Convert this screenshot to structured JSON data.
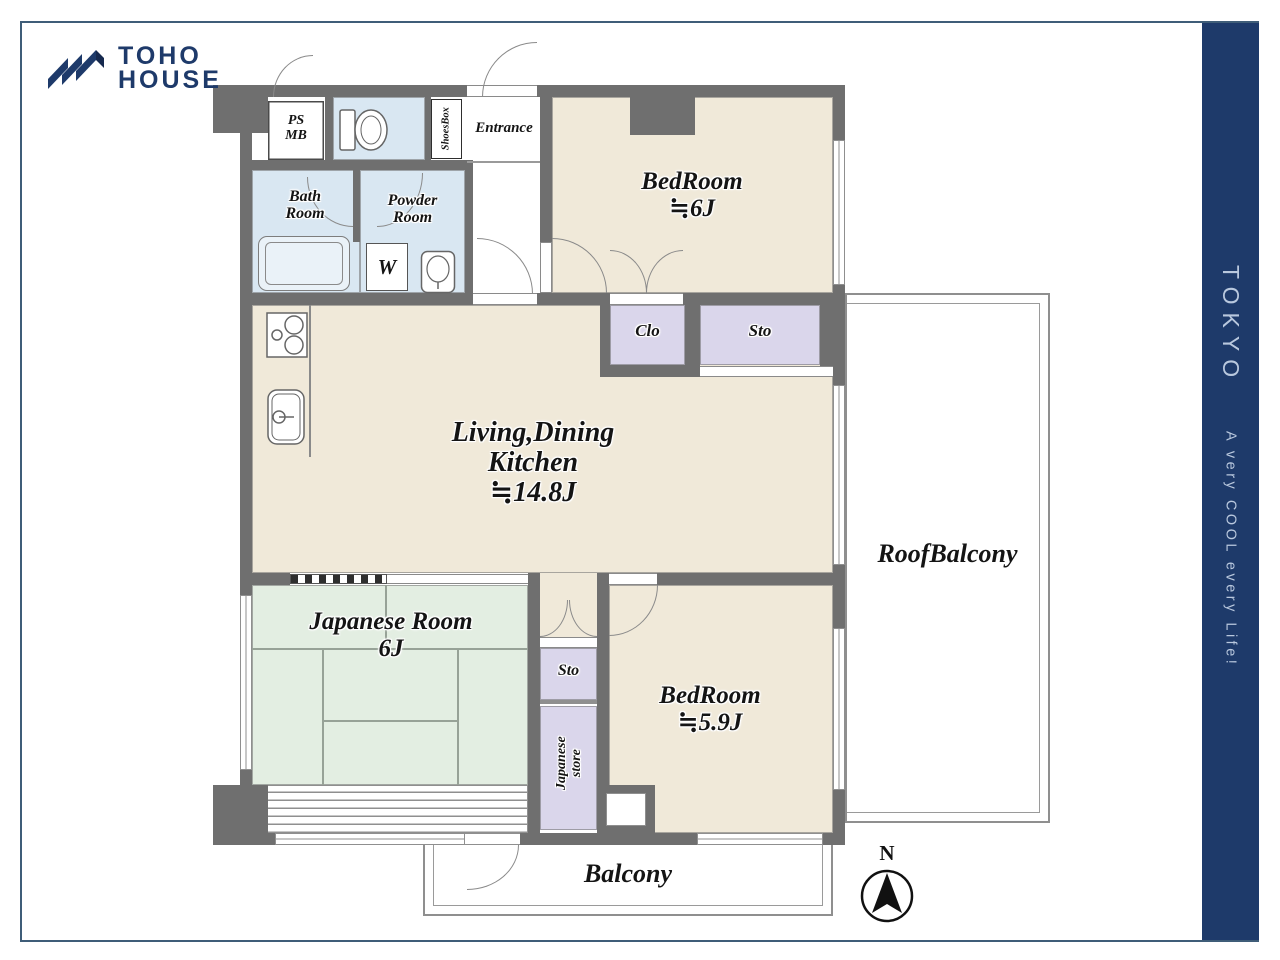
{
  "brand": {
    "name_line1": "TOHO",
    "name_line2": "HOUSE"
  },
  "sidebar": {
    "region": "TOKYO",
    "tagline": "A very COOL every Life!"
  },
  "compass": {
    "north": "N"
  },
  "rooms": {
    "bedroom_north": {
      "name": "BedRoom",
      "size": "≒6J"
    },
    "ldk": {
      "line1": "Living,Dining",
      "line2": "Kitchen",
      "size": "≒14.8J"
    },
    "japanese_room": {
      "name": "Japanese Room",
      "size": "6J"
    },
    "bedroom_south": {
      "name": "BedRoom",
      "size": "≒5.9J"
    },
    "roof_balcony": "RoofBalcony",
    "balcony": "Balcony",
    "closet": "Clo",
    "storage_north": "Sto",
    "storage_south": "Sto",
    "japanese_store_line1": "Japanese",
    "japanese_store_line2": "store",
    "bath_line1": "Bath",
    "bath_line2": "Room",
    "powder_line1": "Powder",
    "powder_line2": "Room",
    "entrance": "Entrance",
    "shoes_box": "ShoesBox",
    "ps_line1": "PS",
    "ps_line2": "MB",
    "washer": "W"
  },
  "colors": {
    "brand_navy": "#1e3a6a",
    "frame_border": "#3f5d78",
    "wall_gray": "#6f6f6f",
    "room_beige": "#f0e9d9",
    "tatami_green": "#e3eee2",
    "wet_blue": "#d9e7f2",
    "closet_lavender": "#dad6eb",
    "banner_text": "#b9c8de"
  }
}
